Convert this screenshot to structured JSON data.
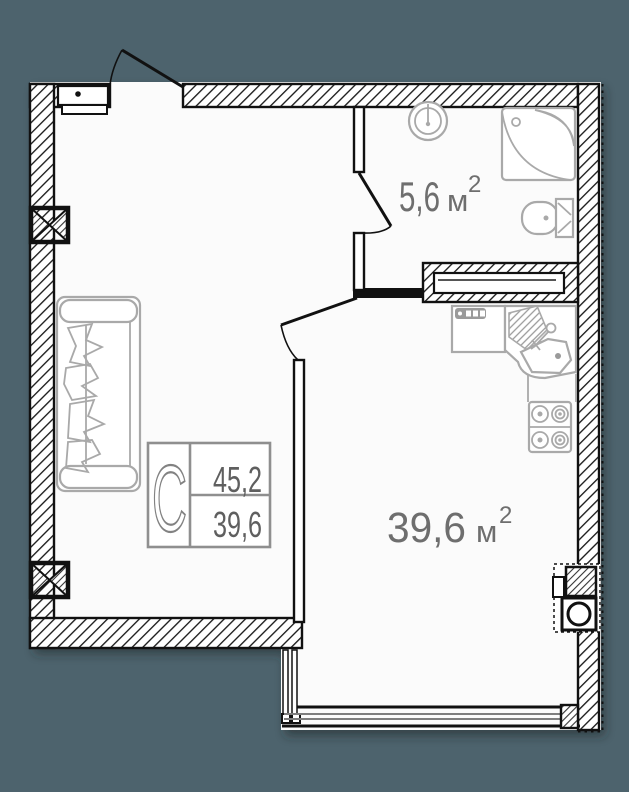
{
  "legend": {
    "type_label": "С",
    "total_area": "45,2",
    "living_area": "39,6"
  },
  "rooms": {
    "bathroom": {
      "area": "5,6",
      "unit": "м",
      "sup": "2"
    },
    "living": {
      "area": "39,6",
      "unit": "м",
      "sup": "2"
    }
  },
  "colors": {
    "page_background": "#4d636d",
    "floor": "#fbfbfb",
    "wall_line": "#111111",
    "furniture_line": "#a9a9a9",
    "room_label_text": "#6e6e6e",
    "legend_text": "#5f5f5f",
    "legend_border": "#8f8f8f"
  },
  "fixtures": [
    "entrance-door",
    "bathroom-door",
    "kitchen-door",
    "sofa",
    "bathroom-sink",
    "corner-shower",
    "toilet",
    "built-in-wardrobe",
    "washing-machine",
    "kitchen-sink",
    "stove",
    "ventilation-shaft",
    "balcony-window",
    "column-marker",
    "column-marker"
  ]
}
